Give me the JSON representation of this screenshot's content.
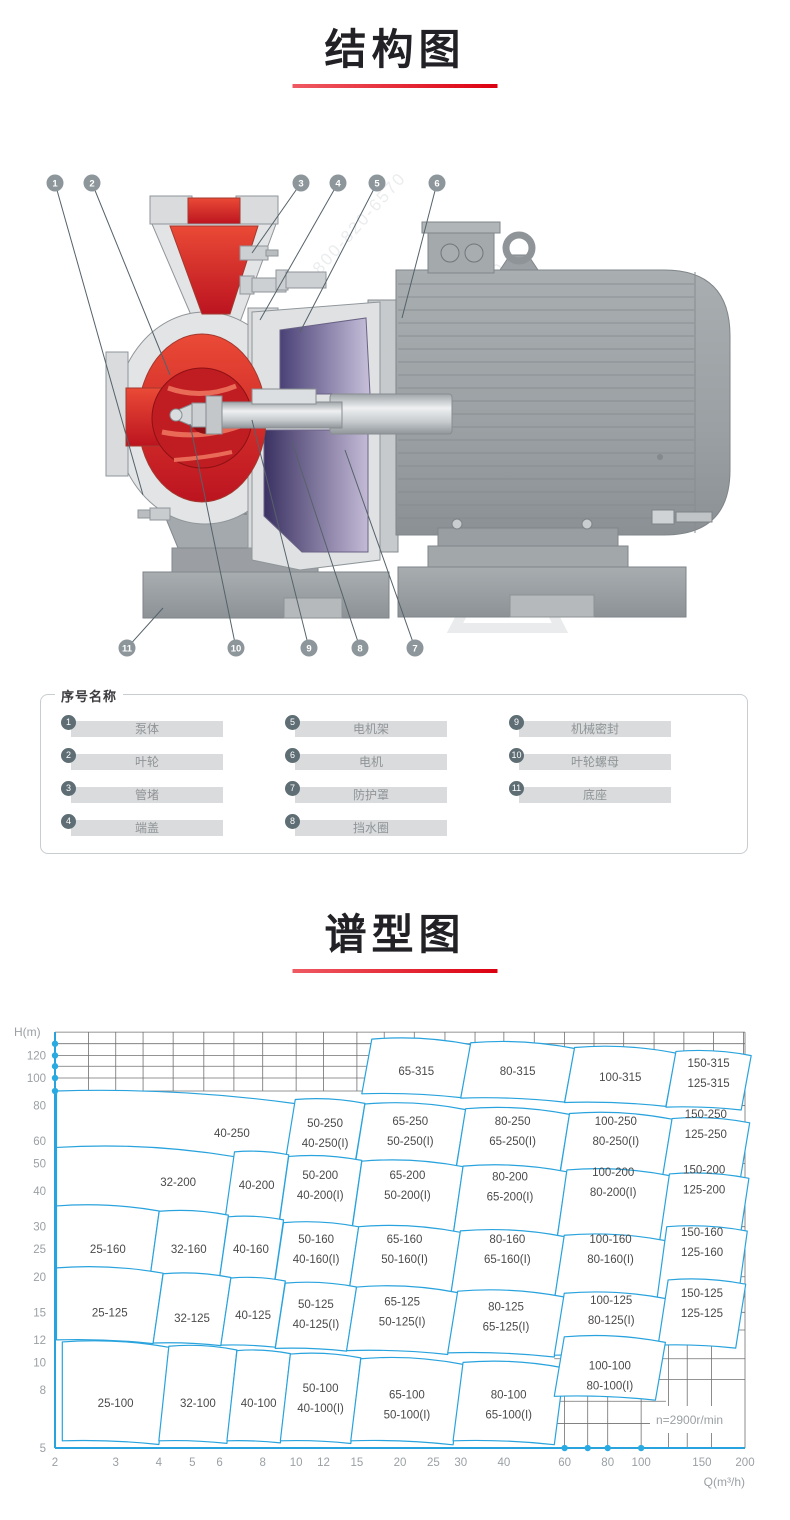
{
  "page": {
    "title1": "结构图",
    "title2": "谱型图",
    "accent_color": "#dc0011"
  },
  "structure": {
    "watermark_text": "800-820-6570",
    "watermark_spots": [
      [
        235,
        345
      ],
      [
        420,
        205
      ],
      [
        595,
        330
      ],
      [
        320,
        115
      ]
    ],
    "callouts": [
      {
        "num": "1",
        "bx": 55,
        "by": 23,
        "tx": 143,
        "ty": 335
      },
      {
        "num": "2",
        "bx": 92,
        "by": 23,
        "tx": 170,
        "ty": 215
      },
      {
        "num": "3",
        "bx": 301,
        "by": 23,
        "tx": 252,
        "ty": 93
      },
      {
        "num": "4",
        "bx": 338,
        "by": 23,
        "tx": 260,
        "ty": 160
      },
      {
        "num": "5",
        "bx": 377,
        "by": 23,
        "tx": 300,
        "ty": 172
      },
      {
        "num": "6",
        "bx": 437,
        "by": 23,
        "tx": 402,
        "ty": 158
      },
      {
        "num": "11",
        "bx": 127,
        "by": 488,
        "tx": 163,
        "ty": 448
      },
      {
        "num": "10",
        "bx": 236,
        "by": 488,
        "tx": 190,
        "ty": 264
      },
      {
        "num": "9",
        "bx": 309,
        "by": 488,
        "tx": 252,
        "ty": 260
      },
      {
        "num": "8",
        "bx": 360,
        "by": 488,
        "tx": 292,
        "ty": 282
      },
      {
        "num": "7",
        "bx": 415,
        "by": 488,
        "tx": 345,
        "ty": 290
      }
    ]
  },
  "legend": {
    "title": "序号名称",
    "items": [
      {
        "num": "1",
        "label": "泵体"
      },
      {
        "num": "2",
        "label": "叶轮"
      },
      {
        "num": "3",
        "label": "管堵"
      },
      {
        "num": "4",
        "label": "端盖"
      },
      {
        "num": "5",
        "label": "电机架"
      },
      {
        "num": "6",
        "label": "电机"
      },
      {
        "num": "7",
        "label": "防护罩"
      },
      {
        "num": "8",
        "label": "挡水圈"
      },
      {
        "num": "9",
        "label": "机械密封"
      },
      {
        "num": "10",
        "label": "叶轮螺母"
      },
      {
        "num": "11",
        "label": "底座"
      }
    ]
  },
  "chart_data": {
    "type": "region_map",
    "title": "谱型图",
    "x_label": "Q(m³/h)",
    "y_label": "H(m)",
    "x_scale": "log",
    "y_scale": "log",
    "x_range": [
      2,
      200
    ],
    "y_range": [
      5,
      145
    ],
    "speed_note": "n=2900r/min",
    "line_color": "#29a3dd",
    "dot_color": "#29abe2",
    "x_ticks": [
      2,
      3,
      4,
      5,
      6,
      8,
      10,
      12,
      15,
      20,
      25,
      30,
      40,
      60,
      80,
      100,
      150,
      200
    ],
    "y_ticks": [
      120,
      100,
      80,
      60,
      50,
      40,
      30,
      25,
      20,
      15,
      12,
      10,
      8,
      5
    ],
    "axis_dots": {
      "left_H": [
        132,
        120,
        110,
        100,
        90
      ],
      "bottom_Q": [
        60,
        70,
        80,
        100
      ]
    },
    "grid": {
      "top_band_h": [
        145,
        132,
        120,
        110,
        100,
        90
      ],
      "minor_q": [
        2,
        2.5,
        3,
        3.6,
        4.4,
        5.4,
        6.6,
        8,
        10,
        12,
        15,
        18,
        22,
        27,
        33,
        40,
        49,
        60,
        73,
        89,
        109,
        133,
        162,
        198
      ],
      "right_strip_h": [
        80,
        70,
        60,
        50,
        40,
        35,
        30,
        25,
        20,
        17,
        15,
        13
      ],
      "bottom_patch_q": [
        60,
        70,
        80,
        100,
        120,
        136,
        160
      ],
      "bottom_patch_h": [
        10.3,
        8.7,
        7.3,
        6.1
      ]
    },
    "regions": [
      {
        "labels": [
          "65-315"
        ],
        "q": [
          15.5,
          30
        ],
        "h": [
          88,
          137
        ],
        "lh": 106
      },
      {
        "labels": [
          "80-315"
        ],
        "q": [
          30,
          60
        ],
        "h": [
          85,
          133
        ],
        "lh": 106
      },
      {
        "labels": [
          "100-315"
        ],
        "q": [
          60,
          118
        ],
        "h": [
          82,
          128
        ],
        "lh": 101
      },
      {
        "labels": [
          "150-315",
          "125-315"
        ],
        "q": [
          118,
          195
        ],
        "h": [
          79,
          124
        ],
        "lh": 104
      },
      {
        "labels": [
          "40-250"
        ],
        "q": [
          2.02,
          9.3
        ],
        "h": [
          53,
          90
        ],
        "lq": 6.3,
        "lh": 64
      },
      {
        "labels": [
          "50-250",
          "40-250(I)"
        ],
        "q": [
          9.3,
          14.8
        ],
        "h": [
          51,
          84
        ],
        "lh": 64
      },
      {
        "labels": [
          "65-250",
          "50-250(I)"
        ],
        "q": [
          14.8,
          29
        ],
        "h": [
          49,
          81
        ],
        "lh": 65
      },
      {
        "labels": [
          "80-250",
          "65-250(I)"
        ],
        "q": [
          29,
          58
        ],
        "h": [
          47,
          78
        ],
        "lh": 65
      },
      {
        "labels": [
          "100-250",
          "80-250(I)"
        ],
        "q": [
          58,
          115
        ],
        "h": [
          45,
          75
        ],
        "lh": 65
      },
      {
        "labels": [
          "150-250",
          "125-250"
        ],
        "q": [
          115,
          193
        ],
        "h": [
          44,
          72
        ],
        "lh": 69
      },
      {
        "labels": [
          "32-200"
        ],
        "q": [
          2.02,
          6.2
        ],
        "h": [
          32,
          57
        ],
        "lq": 4.4,
        "lh": 43
      },
      {
        "labels": [
          "40-200"
        ],
        "q": [
          6.2,
          8.9
        ],
        "h": [
          31,
          55
        ],
        "lh": 42
      },
      {
        "labels": [
          "50-200",
          "40-200(I)"
        ],
        "q": [
          8.9,
          14.5
        ],
        "h": [
          30,
          53
        ],
        "lh": 42
      },
      {
        "labels": [
          "65-200",
          "50-200(I)"
        ],
        "q": [
          14.5,
          28.5
        ],
        "h": [
          29,
          51
        ],
        "lh": 42
      },
      {
        "labels": [
          "80-200",
          "65-200(I)"
        ],
        "q": [
          28.5,
          57
        ],
        "h": [
          28,
          49
        ],
        "lh": 41.5
      },
      {
        "labels": [
          "100-200",
          "80-200(I)"
        ],
        "q": [
          57,
          113
        ],
        "h": [
          27,
          47.5
        ],
        "lh": 43
      },
      {
        "labels": [
          "150-200",
          "125-200"
        ],
        "q": [
          113,
          192
        ],
        "h": [
          26.5,
          46
        ],
        "lh": 44
      },
      {
        "labels": [
          "25-160"
        ],
        "q": [
          2.02,
          3.75
        ],
        "h": [
          19.5,
          35.5
        ],
        "lh": 25
      },
      {
        "labels": [
          "32-160"
        ],
        "q": [
          3.75,
          5.95
        ],
        "h": [
          19,
          34
        ],
        "lh": 25
      },
      {
        "labels": [
          "40-160"
        ],
        "q": [
          5.95,
          8.6
        ],
        "h": [
          18.5,
          32.5
        ],
        "lh": 25
      },
      {
        "labels": [
          "50-160",
          "40-160(I)"
        ],
        "q": [
          8.6,
          14.2
        ],
        "h": [
          18,
          31
        ],
        "lh": 25
      },
      {
        "labels": [
          "65-160",
          "50-160(I)"
        ],
        "q": [
          14.2,
          28
        ],
        "h": [
          17.5,
          30
        ],
        "lh": 25
      },
      {
        "labels": [
          "80-160",
          "65-160(I)"
        ],
        "q": [
          28,
          56
        ],
        "h": [
          17,
          29
        ],
        "lh": 25
      },
      {
        "labels": [
          "100-160",
          "80-160(I)"
        ],
        "q": [
          56,
          111
        ],
        "h": [
          16.5,
          28
        ],
        "lh": 25
      },
      {
        "labels": [
          "150-160",
          "125-160"
        ],
        "q": [
          111,
          190
        ],
        "h": [
          16.5,
          30
        ],
        "lh": 26.5
      },
      {
        "labels": [
          "25-125"
        ],
        "q": [
          2.02,
          3.85
        ],
        "h": [
          12,
          21.5
        ],
        "lh": 15
      },
      {
        "labels": [
          "32-125"
        ],
        "q": [
          3.85,
          6.05
        ],
        "h": [
          11.7,
          20.5
        ],
        "lh": 14.3
      },
      {
        "labels": [
          "40-125"
        ],
        "q": [
          6.05,
          8.7
        ],
        "h": [
          11.5,
          19.8
        ],
        "lh": 14.7
      },
      {
        "labels": [
          "50-125",
          "40-125(I)"
        ],
        "q": [
          8.7,
          14
        ],
        "h": [
          11.2,
          19
        ],
        "lh": 14.8
      },
      {
        "labels": [
          "65-125",
          "50-125(I)"
        ],
        "q": [
          14,
          27.5
        ],
        "h": [
          11,
          18.4
        ],
        "lh": 15.1
      },
      {
        "labels": [
          "80-125",
          "65-125(I)"
        ],
        "q": [
          27.5,
          56
        ],
        "h": [
          10.8,
          17.8
        ],
        "lh": 14.5
      },
      {
        "labels": [
          "100-125",
          "80-125(I)"
        ],
        "q": [
          56,
          112
        ],
        "h": [
          10.6,
          17.5
        ],
        "lh": 15.3
      },
      {
        "labels": [
          "150-125",
          "125-125"
        ],
        "q": [
          112,
          188
        ],
        "h": [
          11.5,
          19.5
        ],
        "lh": 16.2
      },
      {
        "labels": [
          "25-100"
        ],
        "q": [
          2.1,
          4
        ],
        "h": [
          5.3,
          11.8
        ],
        "lh": 7.2
      },
      {
        "labels": [
          "32-100"
        ],
        "q": [
          4,
          6.3
        ],
        "h": [
          5.3,
          11.4
        ],
        "lh": 7.2
      },
      {
        "labels": [
          "40-100"
        ],
        "q": [
          6.3,
          9
        ],
        "h": [
          5.3,
          11
        ],
        "lh": 7.2
      },
      {
        "labels": [
          "50-100",
          "40-100(I)"
        ],
        "q": [
          9,
          14.4
        ],
        "h": [
          5.3,
          10.7
        ],
        "lh": 7.5
      },
      {
        "labels": [
          "65-100",
          "50-100(I)"
        ],
        "q": [
          14.4,
          28.5
        ],
        "h": [
          5.3,
          10.3
        ],
        "lh": 7.1
      },
      {
        "labels": [
          "80-100",
          "65-100(I)"
        ],
        "q": [
          28.5,
          56
        ],
        "h": [
          5.3,
          10
        ],
        "lh": 7.1
      },
      {
        "labels": [
          "100-100",
          "80-100(I)"
        ],
        "q": [
          56,
          110
        ],
        "h": [
          7.6,
          12.3
        ],
        "lh": 9
      }
    ]
  }
}
